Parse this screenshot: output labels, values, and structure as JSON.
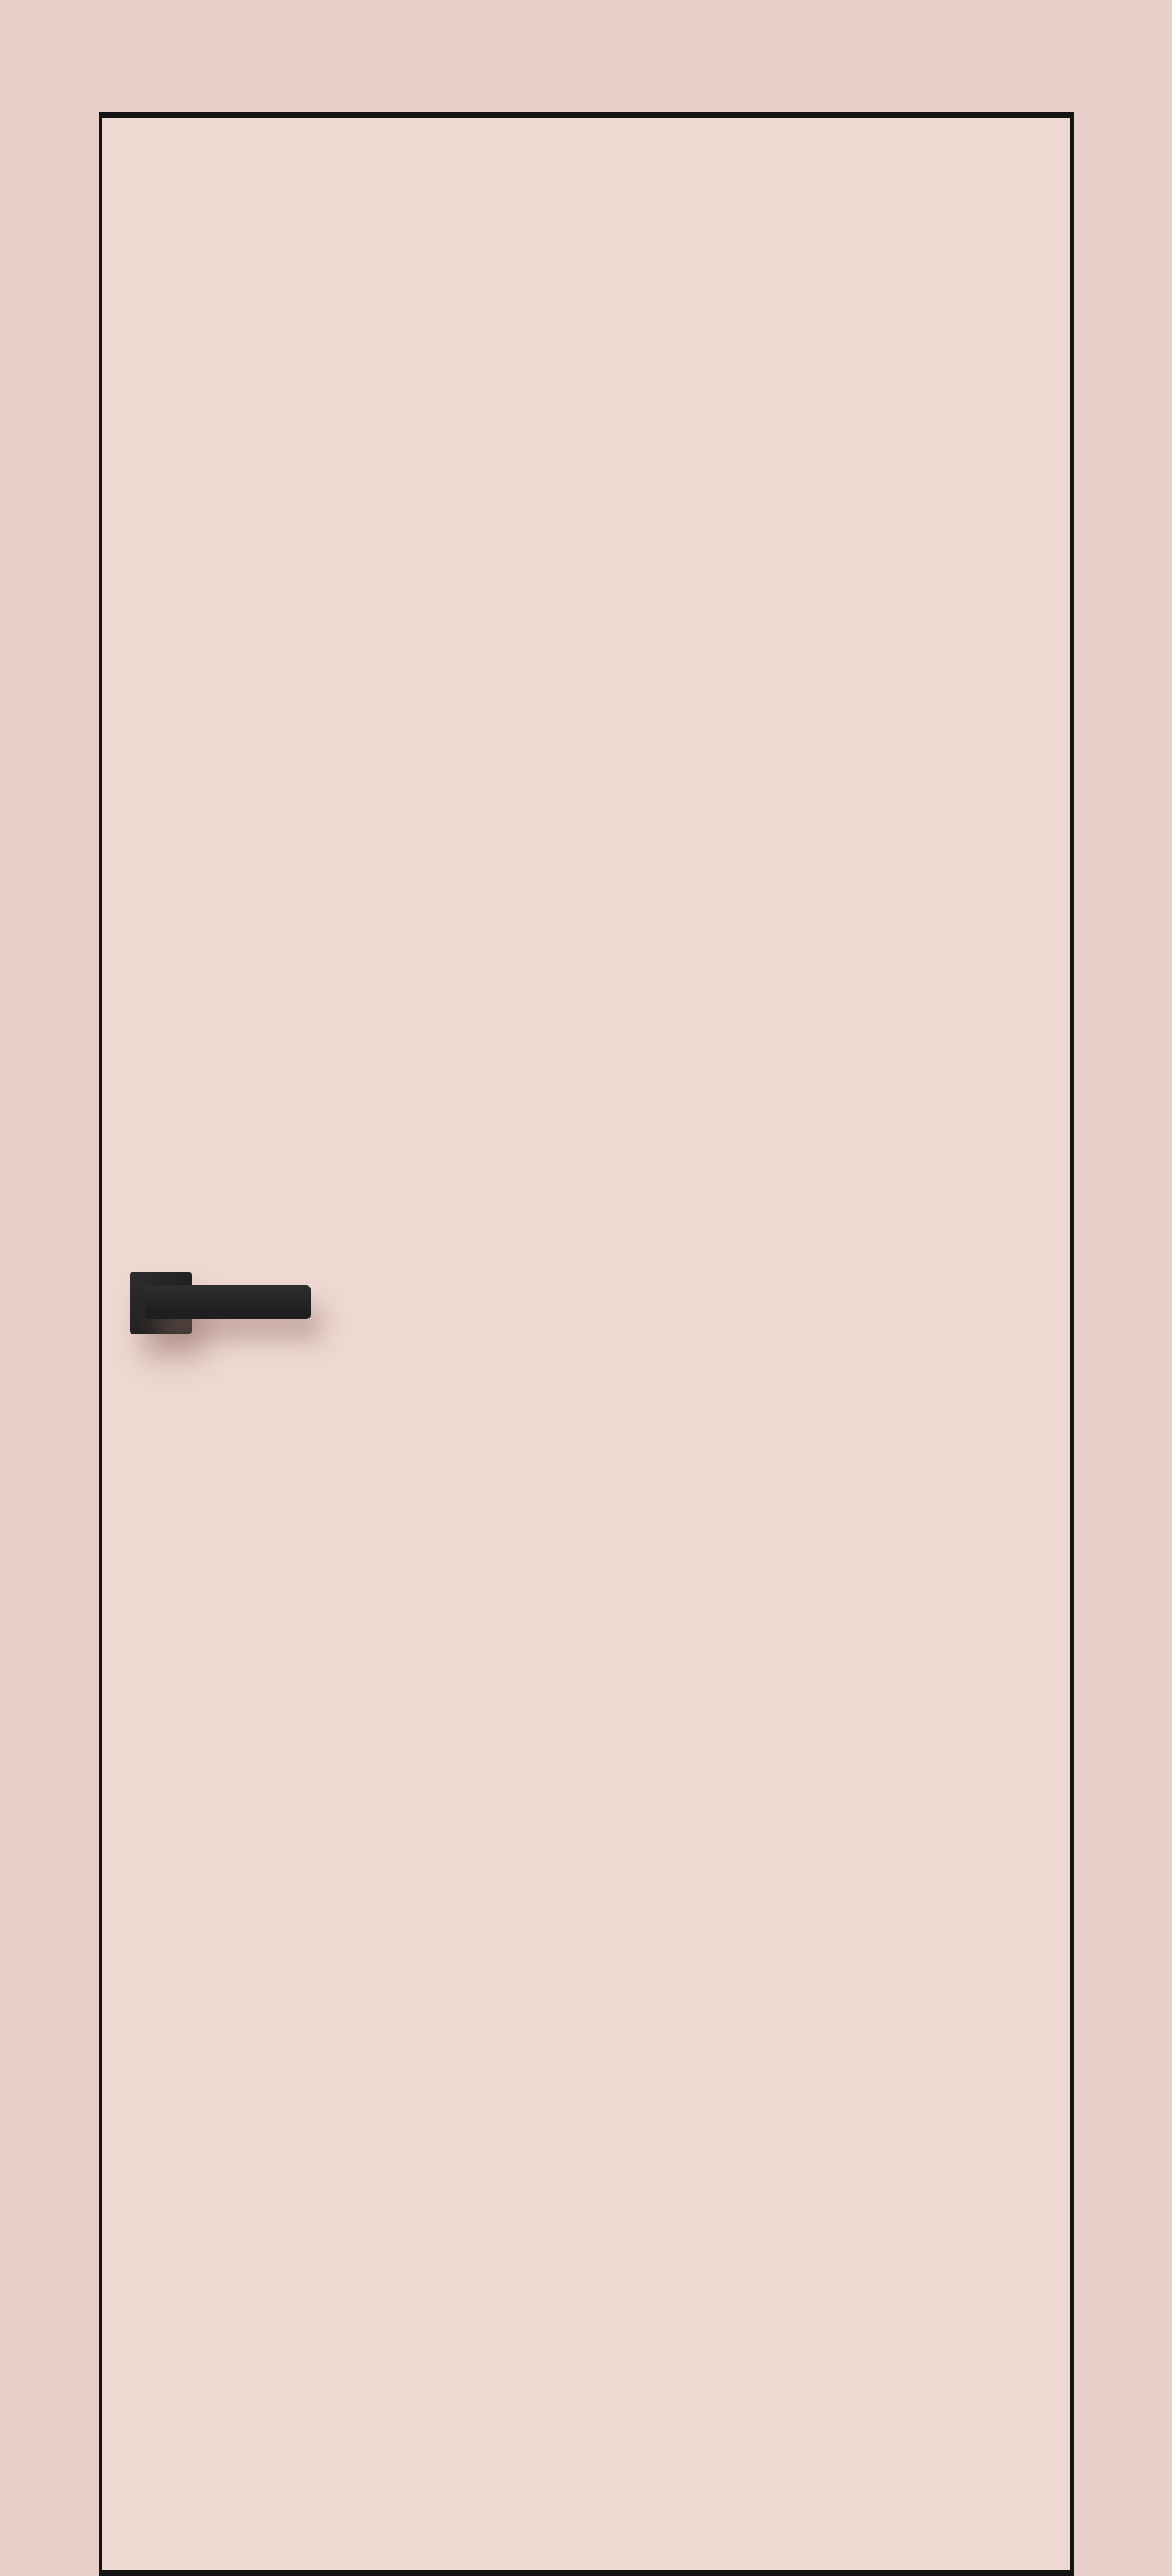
{
  "scene": {
    "type": "product-render",
    "description": "Flush interior door in a pale pink finish with a thin black perimeter outline and a matte black square-rosette lever handle mounted on the left side",
    "colors": {
      "wall": "#e7d0ca",
      "door_face": "#edd8d2",
      "outline": "#141414",
      "handle_dark": "#1f1f1f",
      "handle_light": "#2e2e2e",
      "shadow": "rgba(150,112,104,0.45)"
    },
    "objects": {
      "door_label": "door-panel",
      "handle_label": "door-handle"
    }
  }
}
